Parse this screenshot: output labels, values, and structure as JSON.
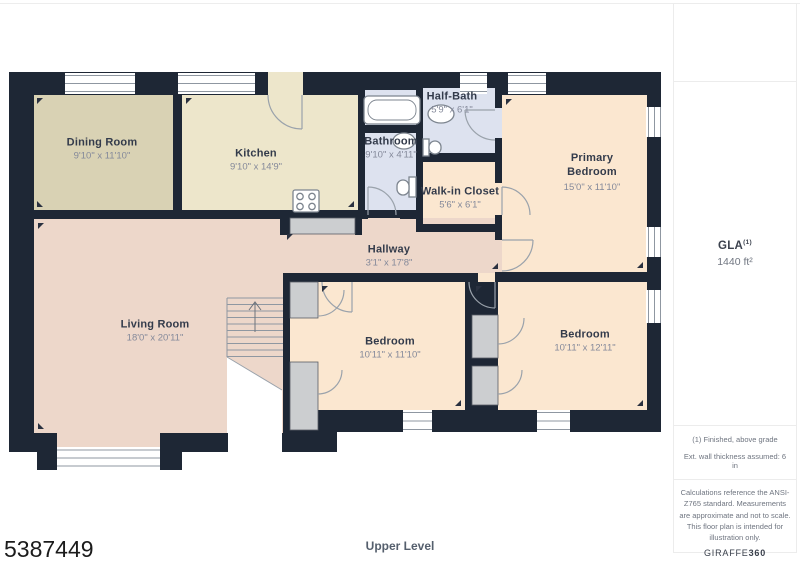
{
  "page": {
    "photo_id": "5387449",
    "level_label": "Upper Level",
    "background": "#ffffff"
  },
  "floor_plan": {
    "rooms": {
      "dining": {
        "name": "Dining Room",
        "dimensions": "9'10\" x 11'10\""
      },
      "kitchen": {
        "name": "Kitchen",
        "dimensions": "9'10\" x 14'9\""
      },
      "bathroom": {
        "name": "Bathroom",
        "dimensions": "9'10\" x 4'11\""
      },
      "half_bath": {
        "name": "Half-Bath",
        "dimensions": "5'9\" x 6'1\""
      },
      "walk_in_closet": {
        "name": "Walk-in Closet",
        "dimensions": "5'6\" x 6'1\""
      },
      "primary_bedroom": {
        "name": "Primary Bedroom",
        "dimensions": "15'0\" x 11'10\""
      },
      "hallway": {
        "name": "Hallway",
        "dimensions": "3'1\" x 17'8\""
      },
      "living": {
        "name": "Living Room",
        "dimensions": "18'0\" x 20'11\""
      },
      "bedroom_mid": {
        "name": "Bedroom",
        "dimensions": "10'11\" x 11'10\""
      },
      "bedroom_right": {
        "name": "Bedroom",
        "dimensions": "10'11\" x 12'11\""
      }
    },
    "colors": {
      "wall": "#1e2735",
      "dining_fill": "#d9d2b4",
      "kitchen_fill": "#ede6cb",
      "bath_fill": "#dde2ef",
      "bedroom_fill": "#fbe7d0",
      "living_fill": "#edd7ca",
      "closet_gray": "#ccced0"
    }
  },
  "sidebar": {
    "gla": {
      "label": "GLA",
      "sup": "(1)",
      "value": "1440 ft²"
    },
    "notes": [
      "(1) Finished, above grade",
      "Ext. wall thickness assumed: 6 in"
    ],
    "disclaimer": "Calculations reference the ANSI-Z765 standard. Measurements are approximate and not to scale. This floor plan is intended for illustration only.",
    "brand": {
      "name": "GIRAFFE",
      "suffix": "360"
    }
  }
}
